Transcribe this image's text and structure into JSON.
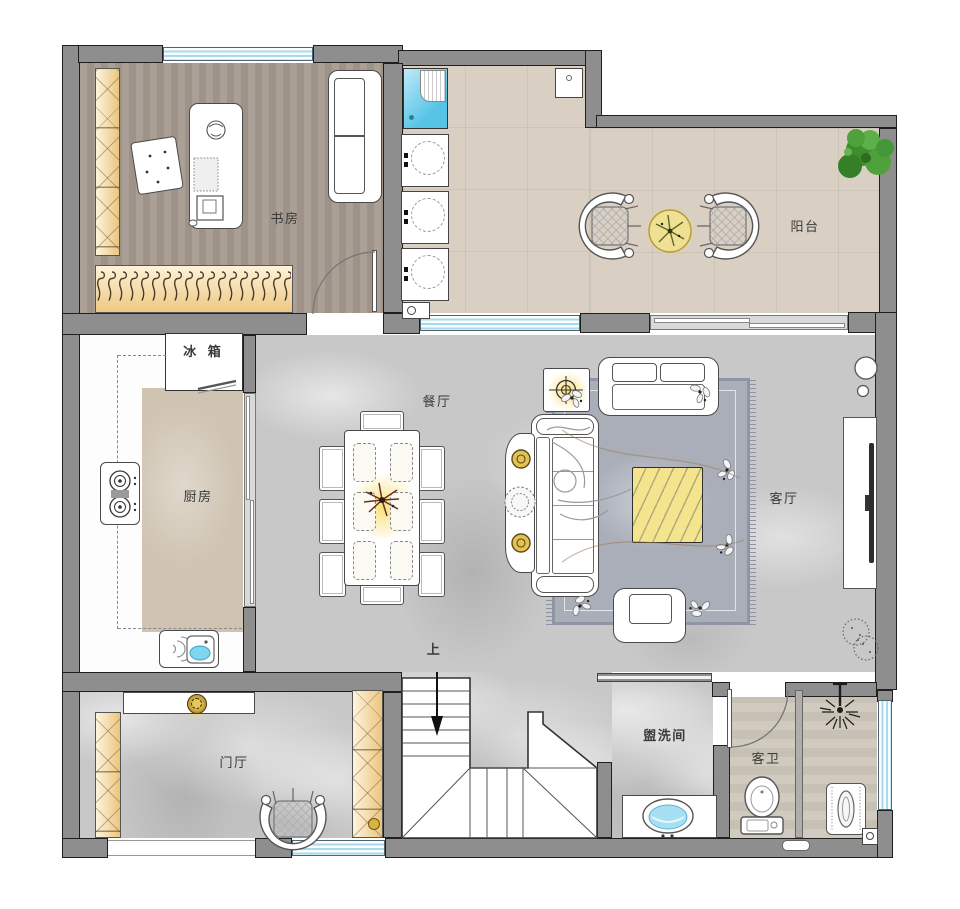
{
  "plan": {
    "rooms": {
      "study": {
        "label": "书房"
      },
      "balcony": {
        "label": "阳台"
      },
      "kitchen": {
        "label": "厨房"
      },
      "fridge": {
        "label": "冰 箱"
      },
      "dining": {
        "label": "餐厅"
      },
      "living": {
        "label": "客厅"
      },
      "entry": {
        "label": "门厅"
      },
      "washroom": {
        "label": "盥洗间"
      },
      "guest_bath": {
        "label": "客卫"
      },
      "stairs_up": {
        "label": "上"
      }
    },
    "colors": {
      "wall_gray": "#8e8e8e",
      "window_blue": "#a9d9ec",
      "wardrobe_cream": "#ecc57f",
      "accent_yellow": "#f3e089",
      "plant_green": "#459a35",
      "marble_gray": "#c8c8c8",
      "study_wood": "#a69a90",
      "balcony_tile": "#d9d0c3"
    }
  }
}
